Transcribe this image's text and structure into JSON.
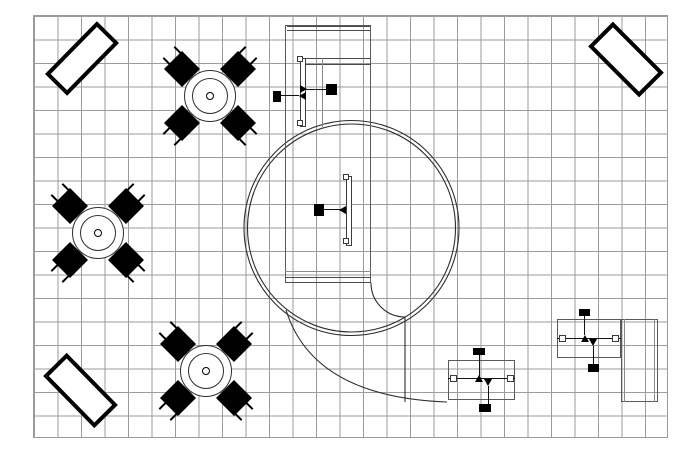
{
  "palette": {
    "ink": "#000000",
    "cad_line": "#2e2e2e",
    "grid_line": "#9b9b9b",
    "background": "#ffffff"
  },
  "grid": {
    "style": "left:33px;top:15px;width:635px;height:423px"
  },
  "benches": [
    {
      "id": "bench-top-left",
      "style": "left:45px;top:43px;width:74px;height:31px;transform:rotate(-45.5deg)"
    },
    {
      "id": "bench-top-right",
      "style": "left:590px;top:42px;width:72px;height:35px;transform:rotate(45deg)"
    },
    {
      "id": "bench-bottom-left",
      "style": "left:44px;top:374px;width:73px;height:33px;transform:rotate(45.5deg)"
    }
  ],
  "tables": [
    {
      "id": "round-table-1",
      "style": "left:150px;top:36px"
    },
    {
      "id": "round-table-2",
      "style": "left:38px;top:173px"
    },
    {
      "id": "round-table-3",
      "style": "left:146px;top:311px"
    }
  ],
  "rotunda": {
    "cx": "351.5",
    "cy": "228",
    "r_outer": "107.5",
    "r_inner": "104"
  },
  "curves": {
    "swoosh_d": "M286,310 C300,355 340,398 447,402",
    "ramp_d": "M371,283 A34,34 0 0 0 405,317 L405,402"
  },
  "counter": {
    "outline": {
      "style": "left:285px;top:25px;width:86px;height:258px"
    },
    "top_strip": {
      "style": "left:287px;top:26px;width:83px;height:5px"
    },
    "shelf_band": {
      "style": "left:300px;top:58px;width:71px;height:7px"
    },
    "faint_divider": {
      "style": "left:322px;top:58px;height:69px"
    },
    "side_table": {
      "style": "left:300px;top:58px;width:6px;height:69px"
    },
    "clip_top": {
      "style": "left:297px;top:56px;width:6px;height:6px"
    },
    "clip_bottom": {
      "style": "left:297px;top:120px;width:6px;height:6px"
    },
    "chair_left": {
      "style": "left:273px;top:91px;width:8px;height:11px"
    },
    "line_left": {
      "style": "left:281px;top:95px;width:18px"
    },
    "marker_left": {
      "style": "left:299px;top:92px"
    },
    "chair_right": {
      "style": "left:326px;top:84px;width:11px;height:11px"
    },
    "line_right": {
      "style": "left:306px;top:89px;width:20px"
    },
    "marker_right": {
      "style": "left:300px;top:85px"
    },
    "bottom_line": {
      "style": "left:285px;top:271px;width:86px"
    },
    "bottom_strip": {
      "style": "left:285px;top:277px;width:86px;height:6px"
    }
  },
  "rotunda_desk": {
    "table": {
      "style": "left:346px;top:176px;width:6px;height:70px"
    },
    "clip_top": {
      "style": "left:343px;top:174px;width:6px;height:6px"
    },
    "clip_bottom": {
      "style": "left:343px;top:238px;width:6px;height:6px"
    },
    "chair": {
      "style": "left:314px;top:204px;width:10px;height:12px"
    },
    "line": {
      "style": "left:324px;top:209px;width:17px"
    },
    "marker": {
      "style": "left:339px;top:206px"
    }
  },
  "workstations": [
    {
      "id": "workstation-1",
      "top": {
        "style": "left:448px;top:360px;width:67px;height:40px"
      },
      "mid_line": {
        "style": "left:448px;top:378px;width:67px"
      },
      "clip_left": {
        "style": "left:450px;top:375px;width:7px;height:7px"
      },
      "clip_right": {
        "style": "left:507px;top:375px;width:7px;height:7px"
      },
      "chair_top": {
        "style": "left:473px;top:348px;width:12px;height:7px"
      },
      "link_top": {
        "style": "left:479px;top:355px;height:21px"
      },
      "marker_up": {
        "style": "left:475px;top:375px"
      },
      "marker_down": {
        "style": "left:484px;top:379px"
      },
      "link_bottom": {
        "style": "left:488px;top:386px;height:18px"
      },
      "chair_bottom": {
        "style": "left:479px;top:404px;width:12px;height:8px"
      }
    },
    {
      "id": "workstation-2",
      "top": {
        "style": "left:557px;top:319px;width:64px;height:39px"
      },
      "mid_line": {
        "style": "left:557px;top:338px;width:64px"
      },
      "clip_left": {
        "style": "left:559px;top:335px;width:7px;height:7px"
      },
      "clip_right": {
        "style": "left:612px;top:335px;width:7px;height:7px"
      },
      "chair_top": {
        "style": "left:579px;top:309px;width:11px;height:7px"
      },
      "link_top": {
        "style": "left:584px;top:316px;height:19px"
      },
      "marker_up": {
        "style": "left:581px;top:335px"
      },
      "marker_down": {
        "style": "left:589px;top:339px"
      },
      "link_bottom": {
        "style": "left:593px;top:346px;height:18px"
      },
      "chair_bottom": {
        "style": "left:588px;top:364px;width:11px;height:8px"
      }
    }
  ],
  "side_return": {
    "outline": {
      "style": "left:621px;top:319px;width:37px;height:83px"
    },
    "inner_left": {
      "style": "left:624px;top:319px;height:83px"
    },
    "inner_right": {
      "style": "left:654px;top:319px;height:83px"
    }
  }
}
